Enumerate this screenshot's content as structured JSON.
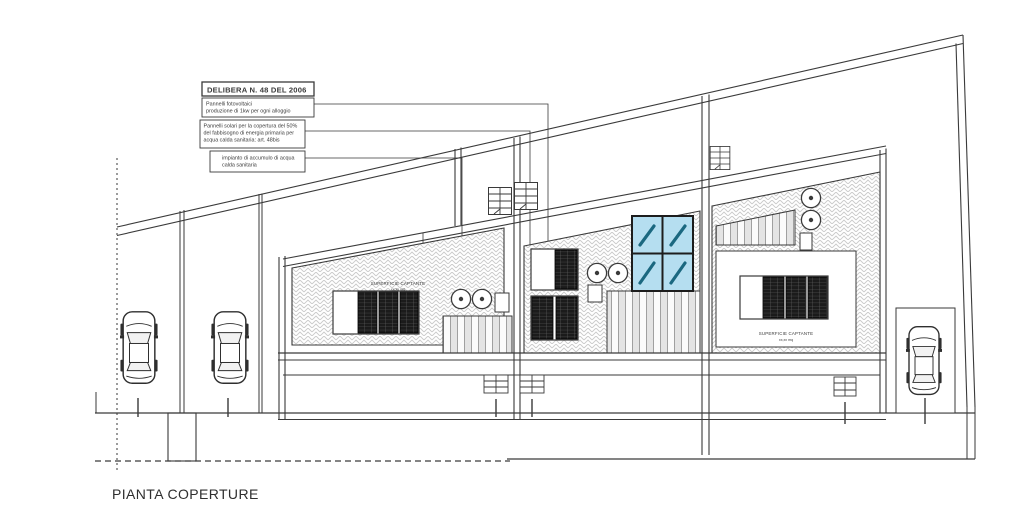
{
  "drawing": {
    "title": "PIANTA COPERTURE",
    "legend": {
      "title": "DELIBERA N. 48 DEL 2006",
      "note_photovoltaic": [
        "Pannelli fotovoltaici",
        "produzione di 1kw per ogni alloggio"
      ],
      "note_solar": [
        "Pannelli solari per la copertura del 50%",
        "del fabbisogno di energia primaria per",
        "acqua calda sanitaria: art. 48bis"
      ],
      "note_storage": [
        "impianto di accumulo di acqua",
        "calda sanitaria"
      ]
    },
    "roof_labels": {
      "left_surface_1": "SUPERFICIE CAPTANTE",
      "left_surface_2": "xx,xx mq",
      "right_surface_1": "SUPERFICIE CAPTANTE",
      "right_surface_2": "xx,xx mq"
    },
    "colors": {
      "line": "#3a3a3a",
      "hatch": "#c9c9c9",
      "panel_dark": "#1b1b1b",
      "skylight_blue": "#b5def0",
      "skylight_slash": "#1b6880"
    }
  }
}
